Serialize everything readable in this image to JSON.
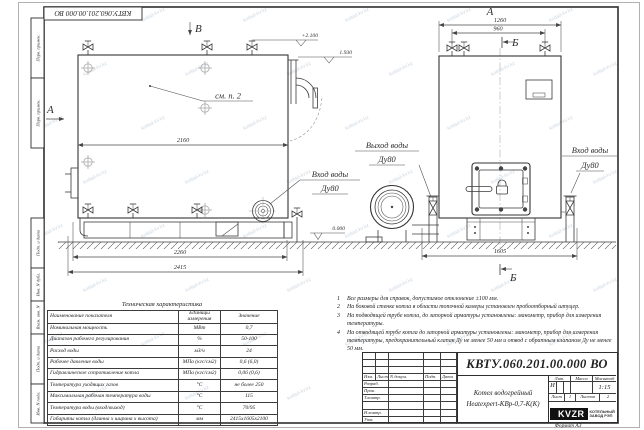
{
  "watermark": "kotlad-kv.kz",
  "stamp_top": "КВТУ.060.201.00.000  ВО",
  "strips": {
    "s0": "Перв. примен.",
    "s1": "Перв. примен.",
    "s2": "Подп. и дата",
    "s3": "Инв. N дубл.",
    "s4": "Взам. инв. N",
    "s5": "Подп. и дата",
    "s6": "Инв. N подл."
  },
  "views": {
    "top_arrow": "В",
    "left_arrow": "А",
    "front": "А",
    "section_top": "Б",
    "section_bottom": "Б",
    "see_note": "см. п. 2"
  },
  "elev": {
    "top": "+2.100",
    "outlet": "1.930",
    "ground": "0.000"
  },
  "dims": {
    "d2160": "2160",
    "d2260": "2260",
    "d2415": "2415",
    "d1260": "1260",
    "d960": "960",
    "d1605": "1605"
  },
  "ports": {
    "side_in1": "Вход воды",
    "side_in2": "Ду80",
    "out1": "Выход воды",
    "out2": "Ду80",
    "front_in1": "Вход воды",
    "front_in2": "Ду80"
  },
  "table": {
    "title": "Техническая характеристика",
    "h0": "Наименование показателя",
    "h1": "Единицы измерения",
    "h2": "Значение",
    "rows": [
      [
        "Номинальная мощность",
        "МВт",
        "0,7"
      ],
      [
        "Диапазон рабочего регулирования",
        "%",
        "50-100"
      ],
      [
        "Расход воды",
        "м3/ч",
        "24"
      ],
      [
        "Рабочее давление воды",
        "МПа (кгс/см2)",
        "0,6 (6,0)"
      ],
      [
        "Гидравлическое сопротивление котла",
        "МПа (кгс/см2)",
        "0,06 (0,6)"
      ],
      [
        "Температура уходящих газов",
        "°С",
        "не более 250"
      ],
      [
        "Максимальная рабочая температура воды",
        "°С",
        "115"
      ],
      [
        "Температура воды (вход/выход)",
        "°С",
        "70/95"
      ],
      [
        "Габариты котла (длинна х ширина х высота)",
        "мм",
        "2415х1605х2100"
      ]
    ]
  },
  "notes": [
    {
      "n": "1",
      "t": "Все размеры для справок, допустимое отклонение ±100 мм."
    },
    {
      "n": "2",
      "t": "На боковой стенке котла в области топочной камеры установлен пробоотборный штуцер."
    },
    {
      "n": "3",
      "t": "На  подводящей трубе котла, до запорной арматуры установлены: манометр, прибор для измерения температуры."
    },
    {
      "n": "4",
      "t": "На отводящей трубе котла до запорной арматуры установлены: манометр, прибор для измерения температуры, предохранительный клапан Ду не менее 50 мм и отвод с обратным клапаном Ду не менее 50 мм."
    }
  ],
  "tb": {
    "doc": "КВТУ.060.201.00.000  ВО",
    "c0": "Изм.",
    "c1": "Лист",
    "c2": "N докум.",
    "c3": "Подп.",
    "c4": "Дата",
    "r0": "Разраб.",
    "r1": "Пров.",
    "r2": "Т.контр.",
    "r3": "",
    "r4": "Н.контр.",
    "r5": "Утв.",
    "p1": "Котел водогрейный",
    "p2": "Heatexpert-КВр-0,7-К(К)",
    "l0": "Лит.",
    "l1": "Масса",
    "l2": "Масштаб",
    "lit": "И",
    "scale": "1:15",
    "sh0": "Лист",
    "sh1": "1",
    "sh2": "Листов",
    "sh3": "2",
    "logo": "KVZR",
    "co1": "КОТЕЛЬНЫЙ",
    "co2": "ЗАВОД РЭП",
    "fmt": "Формат  А3"
  }
}
